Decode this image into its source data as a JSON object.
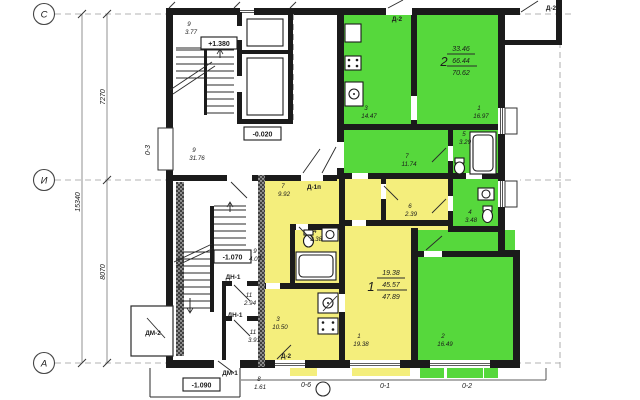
{
  "colors": {
    "apartment1": "#f4ee7c",
    "apartment2": "#56d83c",
    "wall": "#1b1b1b"
  },
  "axes": {
    "row_top": "С",
    "row_mid": "И",
    "row_bottom": "А",
    "col_1": "0-6",
    "col_2": "0-1",
    "col_3": "0-2",
    "wall_mark": "0-3"
  },
  "dimensions": {
    "total": "15340",
    "upper": "7270",
    "lower": "8070"
  },
  "levels": {
    "stair": "+1.380",
    "floor": "-0.020",
    "vestibule": "-1.070",
    "entrance": "-1.090"
  },
  "doors": {
    "d2": "Д-2",
    "d1p": "Д-1п",
    "dn1": "ДН-1",
    "dm1": "ДМ-1",
    "dm2": "ДМ-2"
  },
  "apartments": {
    "apt1": {
      "number": "1",
      "living_area": "19.38",
      "usable_area": "45.57",
      "total_area": "47.89"
    },
    "apt2": {
      "number": "2",
      "living_area": "33.46",
      "usable_area": "66.44",
      "total_area": "70.62"
    }
  },
  "rooms": [
    {
      "n": "9",
      "a": "3.77"
    },
    {
      "n": "9",
      "a": "31.76"
    },
    {
      "n": "9",
      "a": "4.07"
    },
    {
      "n": "11",
      "a": "2.94"
    },
    {
      "n": "11",
      "a": "3.91"
    },
    {
      "n": "8",
      "a": "1.61"
    },
    {
      "n": "3",
      "a": "14.47"
    },
    {
      "n": "1",
      "a": "16.97"
    },
    {
      "n": "5",
      "a": "3.29"
    },
    {
      "n": "7",
      "a": "11.74"
    },
    {
      "n": "4",
      "a": "3.48"
    },
    {
      "n": "2",
      "a": "16.49"
    },
    {
      "n": "7",
      "a": "9.92"
    },
    {
      "n": "6",
      "a": "2.39"
    },
    {
      "n": "4",
      "a": "3.38"
    },
    {
      "n": "3",
      "a": "10.50"
    },
    {
      "n": "1",
      "a": "19.38"
    }
  ]
}
